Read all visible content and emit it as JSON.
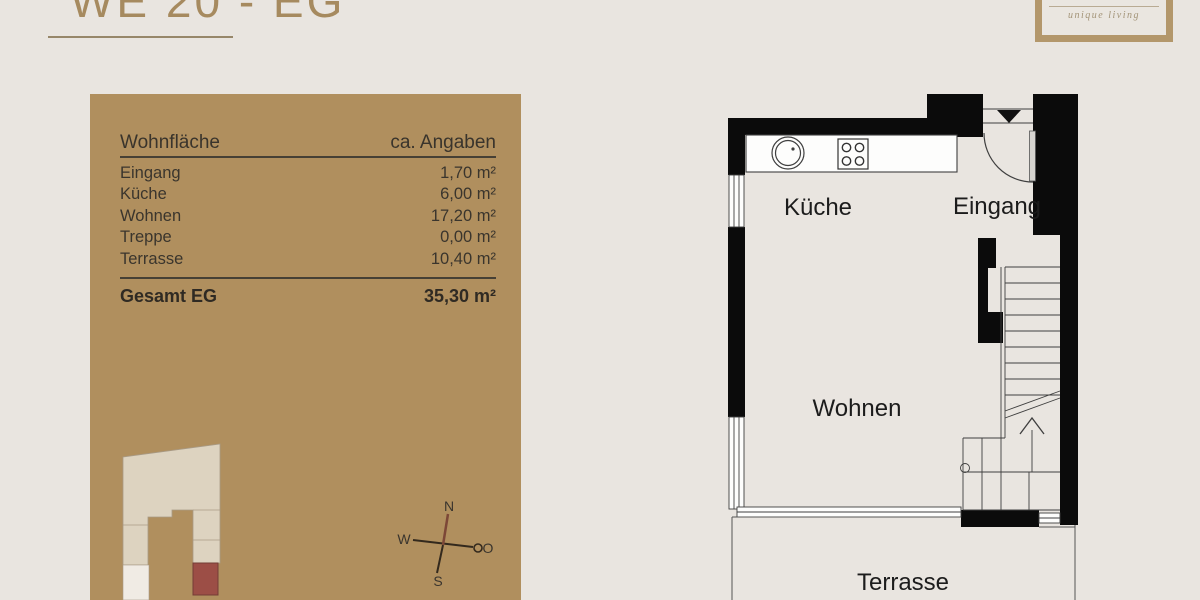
{
  "header": {
    "title": "WE 20 - EG",
    "title_color": "#a68a5f",
    "underline_color": "#97876a"
  },
  "logo": {
    "text": "unique living",
    "border_color": "#b3976b"
  },
  "panel": {
    "bg_color": "#b08f5e",
    "table": {
      "header": {
        "label": "Wohnfläche",
        "value": "ca. Angaben"
      },
      "rows": [
        {
          "label": "Eingang",
          "value": "1,70 m²"
        },
        {
          "label": "Küche",
          "value": "6,00 m²"
        },
        {
          "label": "Wohnen",
          "value": "17,20 m²"
        },
        {
          "label": "Treppe",
          "value": "0,00 m²"
        },
        {
          "label": "Terrasse",
          "value": "10,40 m²"
        }
      ],
      "total": {
        "label": "Gesamt EG",
        "value": "35,30 m²"
      }
    },
    "site_plan": {
      "building_color": "#ddd3c0",
      "highlight_color": "#9c4e46"
    },
    "compass": {
      "n": "N",
      "w": "W",
      "o": "O",
      "s": "S"
    }
  },
  "floor_plan": {
    "rooms": {
      "kitchen": "Küche",
      "entrance": "Eingang",
      "living": "Wohnen",
      "terrace": "Terrasse"
    },
    "wall_color": "#0b0b0b",
    "line_color": "#3f3f3f"
  }
}
